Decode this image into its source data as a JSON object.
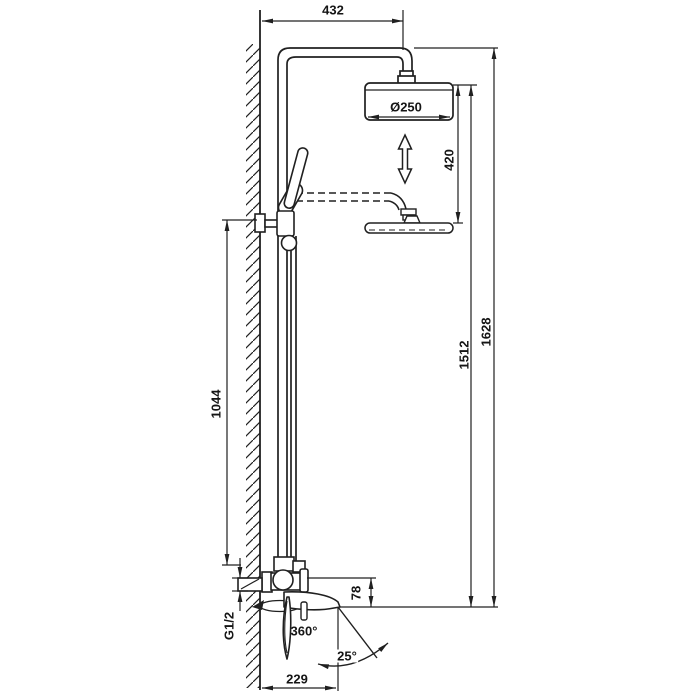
{
  "diagram": {
    "kind": "technical dimension drawing",
    "subject": "wall-mounted shower column with overhead rain shower, hand shower and swivel bath spout",
    "background_color": "#ffffff",
    "line_color": "#202020",
    "labels": {
      "top_offset": "432",
      "head_diameter": "Ø250",
      "height_adjustment": "420",
      "overall_height": "1628",
      "head_height": "1512",
      "riser_height": "1044",
      "spout_drop": "78",
      "inlet_thread": "G1/2",
      "spout_swivel": "360°",
      "handle_tilt": "25°",
      "spout_reach": "229"
    }
  }
}
